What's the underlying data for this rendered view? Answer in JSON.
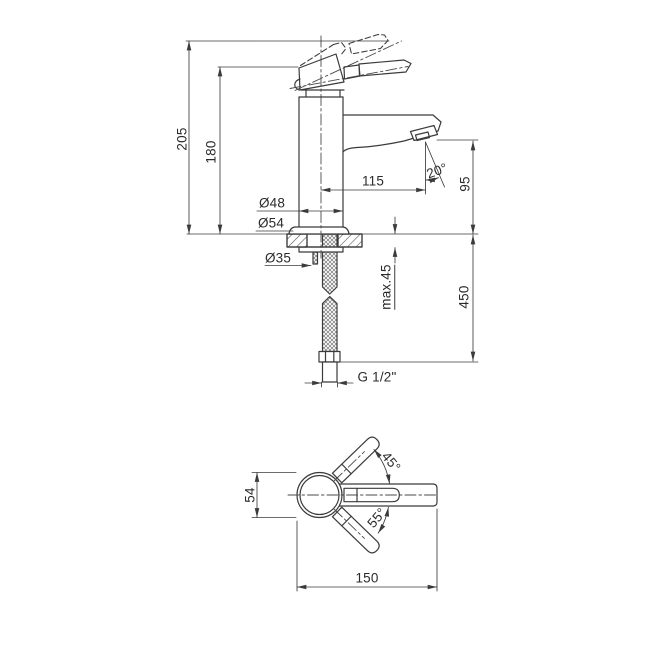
{
  "line_color": "#3b3b3b",
  "views": {
    "front": {
      "labels": {
        "total_height": "205",
        "body_height": "180",
        "body_diameter": "Ø48",
        "base_diameter": "Ø54",
        "shank_diameter": "Ø35",
        "spout_reach": "115",
        "spout_angle": "20°",
        "outlet_height": "95",
        "hose_length": "450",
        "max_deck_thickness": "max.45",
        "connection_thread": "G 1/2\""
      }
    },
    "top": {
      "labels": {
        "body_width": "54",
        "overall_length": "150",
        "handle_open_angle": "45°",
        "handle_close_angle": "55°"
      }
    }
  }
}
